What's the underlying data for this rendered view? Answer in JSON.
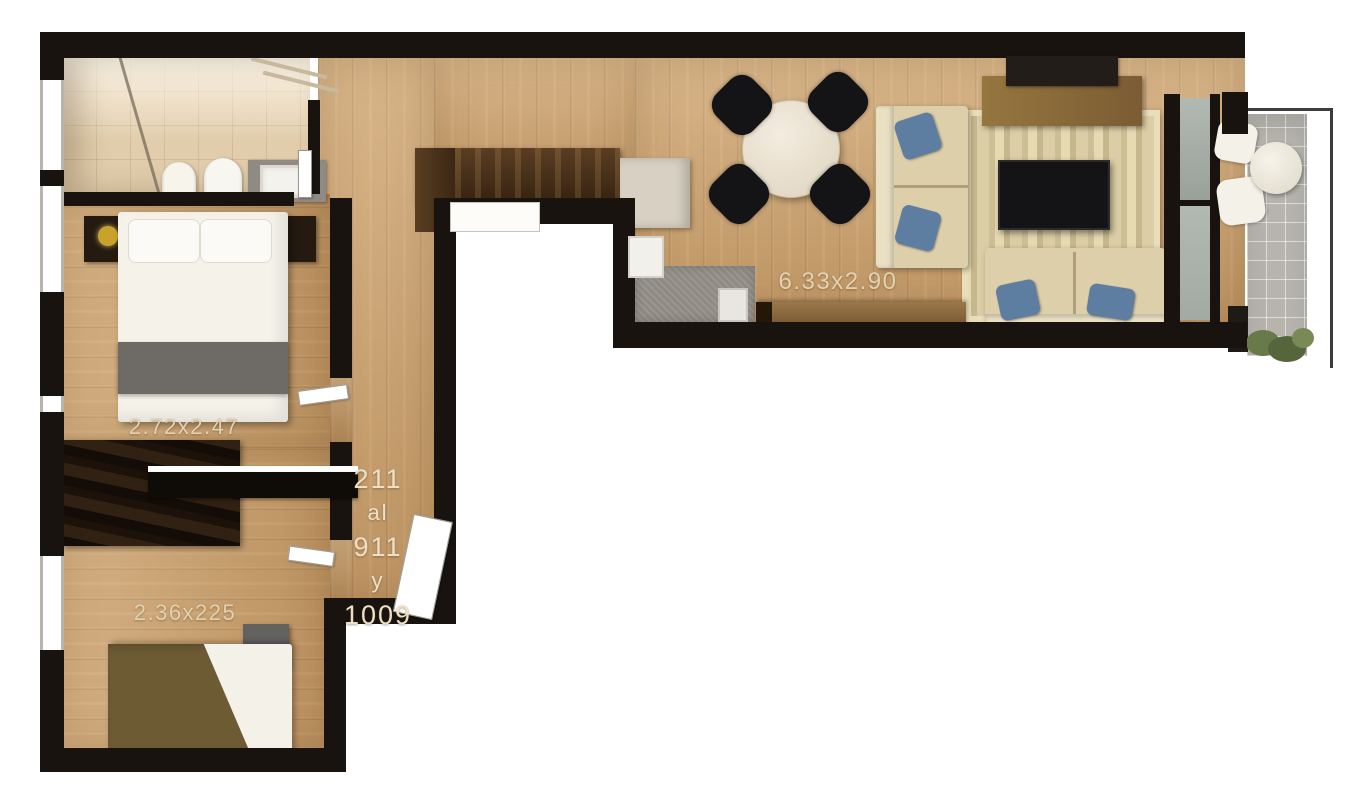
{
  "labels": {
    "bedroom1_dims": "2.72x2.47",
    "bedroom2_dims": "2.36x225",
    "living_dims": "6.33x2.90",
    "units1": "211",
    "units2": "al",
    "units3": "911",
    "units4": "y",
    "units5": "1009"
  },
  "colors": {
    "wall": "#18130e",
    "wood": "#c89e6b",
    "tile": "#e9d8ba",
    "balconytile": "#b6b4ad",
    "dark": "#241a10",
    "gray": "#8f8b84",
    "sofa": "#decfab",
    "sofaback": "#eae0c4",
    "pillow": "#5d7da1",
    "tv": "#141416",
    "consolewood": "#8a6a44",
    "counterdark": "#46301d",
    "olive": "#6d5b34",
    "blanket": "#6e6a66",
    "glass": "#b2b8b2",
    "plant": "#68794a",
    "gold": "#c9a22c",
    "label": "#e0d2b2",
    "units": "#ece0c8"
  }
}
